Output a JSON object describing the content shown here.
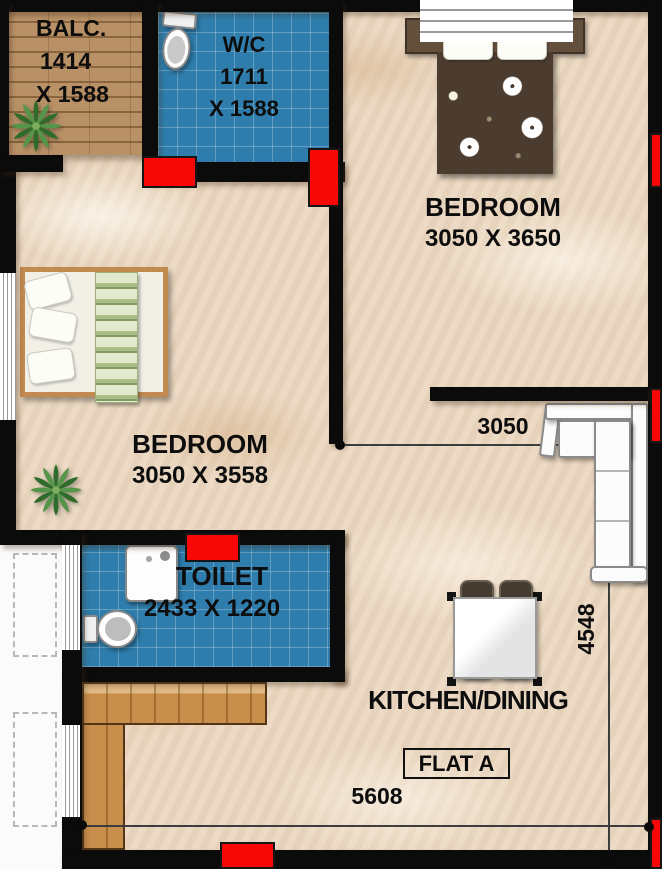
{
  "flat": {
    "label": "FLAT A"
  },
  "rooms": {
    "balcony": {
      "label": "BALC.",
      "dim_line1": "1414",
      "dim_line2": "X 1588"
    },
    "wc": {
      "label": "W/C",
      "dim_line1": "1711",
      "dim_line2": "X 1588"
    },
    "bedroom_top": {
      "label": "BEDROOM",
      "dims": "3050  X 3650"
    },
    "bedroom_left": {
      "label": "BEDROOM",
      "dims": "3050 X 3558"
    },
    "toilet": {
      "label": "TOILET",
      "dims": "2433 X 1220"
    },
    "kitchen_dining": {
      "label": "KITCHEN/DINING"
    }
  },
  "dimensions": {
    "bottom_width": "5608",
    "kitchen_width": "3050",
    "kitchen_depth": "4548"
  },
  "colors": {
    "wall": "#0b0b0b",
    "door": "#f80707",
    "tile_blue": "#2e7dac",
    "floor_marble": "#ebd8c1",
    "balcony_wood": "#b3885a",
    "counter_wood": "#c78e4c",
    "text": "#0d0d0d"
  },
  "icons": {
    "plant": "plant-icon",
    "toilet": "toilet-icon",
    "shower": "shower-icon",
    "bed": "bed",
    "sofa": "sofa",
    "dining_table": "dining-table"
  }
}
